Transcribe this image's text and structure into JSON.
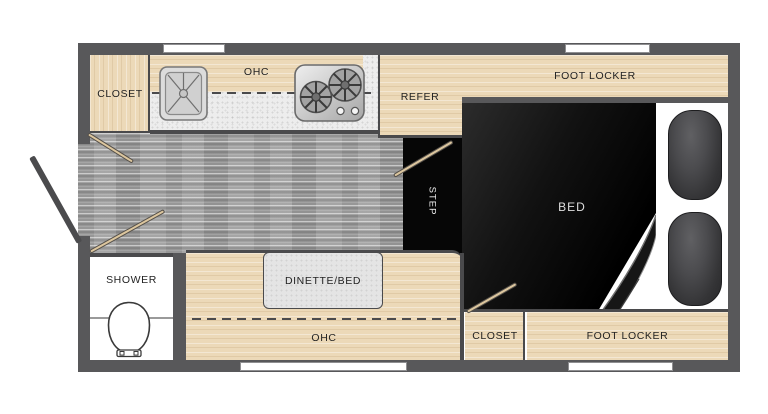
{
  "plan_type": "travel-trailer-floor-plan",
  "labels": {
    "closet_top": "CLOSET",
    "ohc_top": "OHC",
    "refer": "REFER",
    "foot_locker_top": "FOOT LOCKER",
    "bed": "BED",
    "step": "STEP",
    "shower": "SHOWER",
    "dinette_bed": "DINETTE/BED",
    "ohc_bottom": "OHC",
    "closet_bottom": "CLOSET",
    "foot_locker_bottom": "FOOT LOCKER"
  },
  "icons": {
    "sink": "sink-icon",
    "stove": "stove-burners-icon",
    "toilet": "toilet-icon",
    "entry_door": "entry-door-icon",
    "door_swing": "door-swing-icon",
    "window": "window-icon",
    "wheel_well": "wheel-well-icon",
    "bed_fold": "bed-fold-icon"
  },
  "colors": {
    "wall": "#58585a",
    "cabinet_wood": "#ecd9b8",
    "cabinet_edge": "#4a4a4c",
    "counter": "#ededed",
    "floor": "#a0a0a0",
    "bed_black": "#0d0d0d",
    "door_tan": "#dcc69e",
    "table_gray": "#e4e4e4",
    "label_text": "#232323",
    "bed_label_text": "#dedede",
    "background": "#ffffff"
  }
}
